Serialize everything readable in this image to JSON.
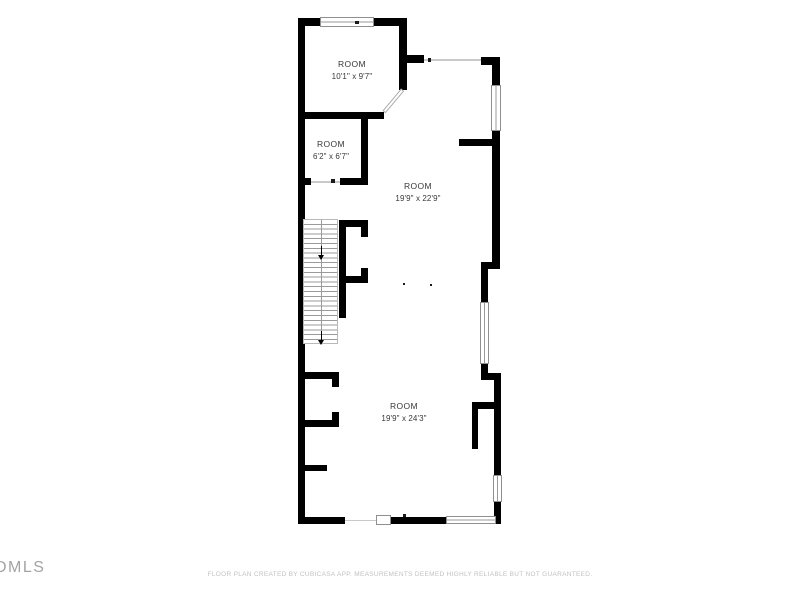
{
  "watermark": {
    "text": "DMLS"
  },
  "footer": {
    "disclaimer": "FLOOR PLAN CREATED BY CUBICASA APP. MEASUREMENTS DEEMED HIGHLY RELIABLE BUT NOT GUARANTEED."
  },
  "rooms": [
    {
      "name": "ROOM",
      "dimensions": "10'1\" x 9'7\""
    },
    {
      "name": "ROOM",
      "dimensions": "6'2\" x 6'7\""
    },
    {
      "name": "ROOM",
      "dimensions": "19'9\" x 22'9\""
    },
    {
      "name": "ROOM",
      "dimensions": "19'9\" x 24'3\""
    }
  ],
  "colors": {
    "wall": "#000000",
    "room_text": "#383838",
    "footer_text": "#c2c2c2",
    "watermark_text": "#a3a3a3",
    "window_frame": "#8f8f8f"
  }
}
